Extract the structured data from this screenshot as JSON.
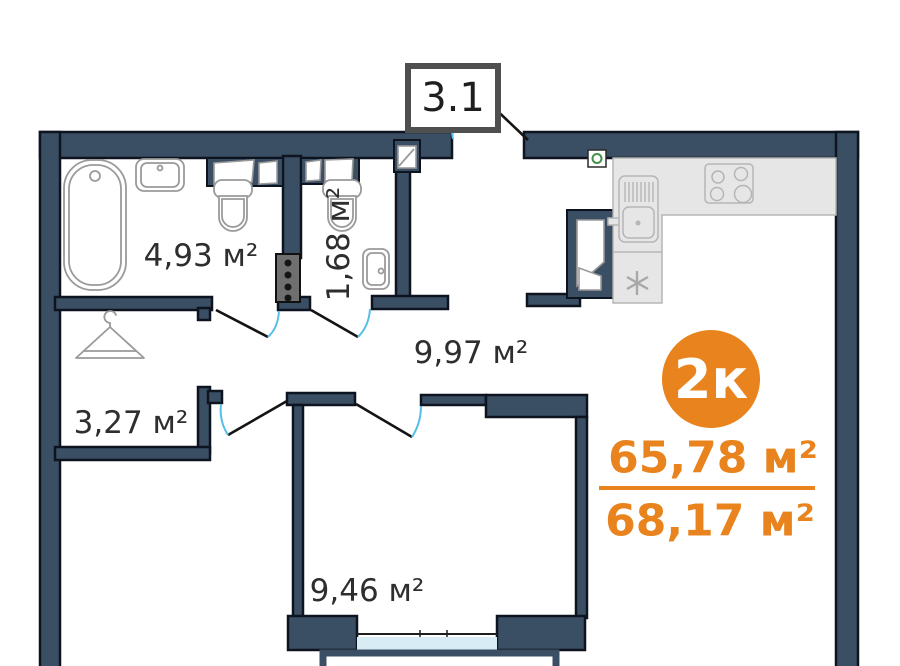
{
  "plan": {
    "section": "3.1",
    "unit_badge": "2к",
    "areas": {
      "main": "65,78 м²",
      "total": "68,17 м²"
    },
    "rooms": {
      "bathroom": "4,93 м²",
      "wc": "1,68 м²",
      "hallway": "9,97 м²",
      "wardrobe": "3,27 м²",
      "bedroom": "9,46 м²"
    },
    "colors": {
      "wall": "#3A4F63",
      "accent_orange": "#E8831D",
      "door_arc": "#55BEE8",
      "balcony_glass": "#D8ECF6",
      "counter_gray": "#E6E6E6",
      "vent_green": "#43904A"
    }
  }
}
